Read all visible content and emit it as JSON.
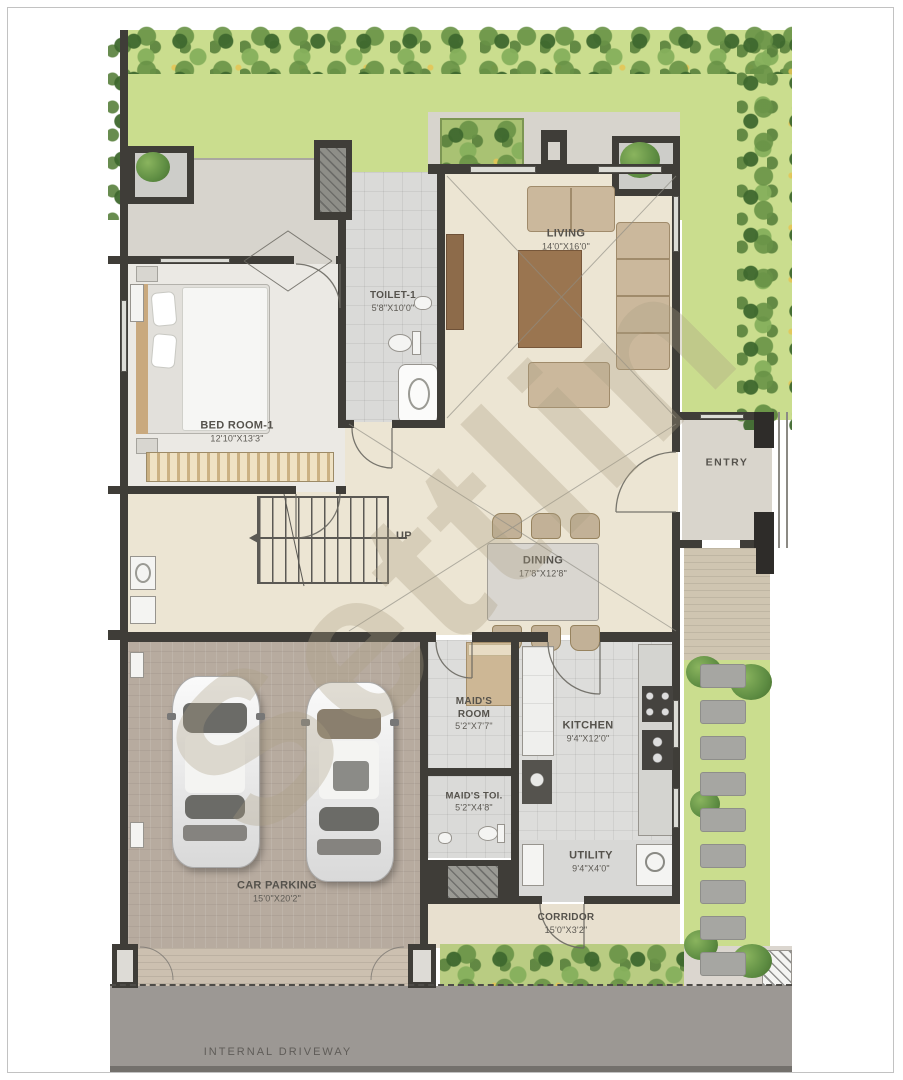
{
  "watermark": {
    "text": "Settlin"
  },
  "site": {
    "up_label": "UP",
    "driveway_label": "INTERNAL DRIVEWAY"
  },
  "rooms": {
    "living": {
      "name": "LIVING",
      "dims": "14'0\"X16'0\""
    },
    "toilet1": {
      "name": "TOILET-1",
      "dims": "5'8\"X10'0\""
    },
    "bedroom1": {
      "name": "BED ROOM-1",
      "dims": "12'10\"X13'3\""
    },
    "dining": {
      "name": "DINING",
      "dims": "17'8\"X12'8\""
    },
    "entry": {
      "name": "ENTRY"
    },
    "maids_room": {
      "name": "MAID'S ROOM",
      "dims": "5'2\"X7'7\""
    },
    "maids_toi": {
      "name": "MAID'S TOI.",
      "dims": "5'2\"X4'8\""
    },
    "kitchen": {
      "name": "KITCHEN",
      "dims": "9'4\"X12'0\""
    },
    "utility": {
      "name": "UTILITY",
      "dims": "9'4\"X4'0\""
    },
    "car_parking": {
      "name": "CAR PARKING",
      "dims": "15'0\"X20'2\""
    },
    "corridor": {
      "name": "CORRIDOR",
      "dims": "15'0\"X3'2\""
    }
  },
  "colors": {
    "wall": "#3f3d38",
    "floor_beige": "#ece5d3",
    "floor_grey": "#dddddb",
    "parking": "#b7ab9f",
    "garden": "#cadd8e",
    "bush_green": "#5d8c42",
    "driveway": "#9c9894",
    "deck": "#d7d4cd",
    "label_text": "#55524c"
  }
}
